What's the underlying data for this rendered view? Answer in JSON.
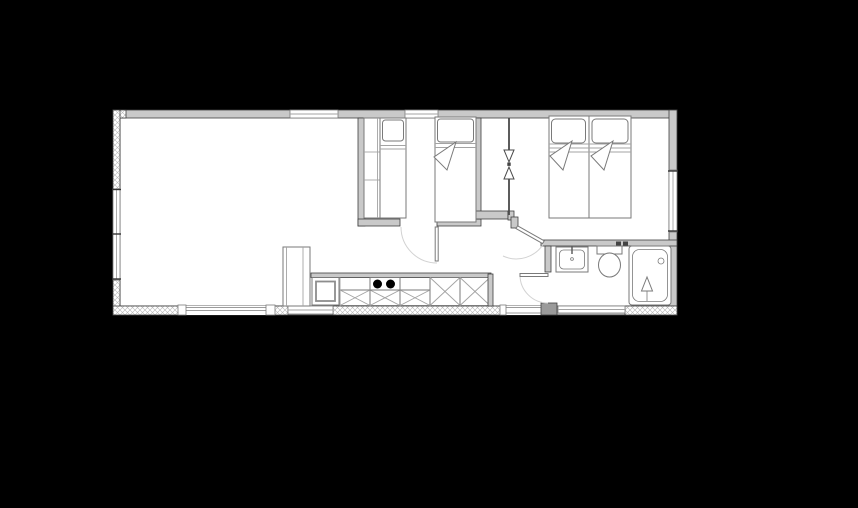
{
  "meta": {
    "description": "Black-background architectural floor plan of a small cabin / mobile home; line drawing only, no visible text labels or dimensions"
  },
  "colors": {
    "background": "#000000",
    "floor": "#ffffff",
    "wall_fill": "#c9c9c9",
    "wall_edge": "#3f3f3f",
    "line": "#7a7a7a",
    "line_light": "#a3a3a3",
    "door_arc": "#d2d2d2",
    "burner": "#000000",
    "hatch_line": "#b5b5b5",
    "pier": "#9a9a9a"
  },
  "floorplan": {
    "rooms": [
      "living-room",
      "kitchen",
      "bedroom-1",
      "hall",
      "bedroom-2",
      "bathroom"
    ],
    "fixtures": [
      "wardrobe",
      "single-bed",
      "single-bed",
      "double-bed",
      "refrigerator",
      "kitchen-counter",
      "sink-cabinet",
      "cooktop-2-burners",
      "base-cabinets-x",
      "appliance-cabinets-x",
      "washbasin",
      "toilet",
      "bathtub",
      "shower-mixer",
      "door-swing-bedroom-1",
      "door-swing-bedroom-2",
      "door-swing-bathroom",
      "sliding-partition-arrows",
      "window",
      "patio-opening",
      "entrance-opening"
    ],
    "counts": {
      "beds": 4,
      "burners": 2,
      "swing_doors": 3,
      "windows": 6
    }
  }
}
